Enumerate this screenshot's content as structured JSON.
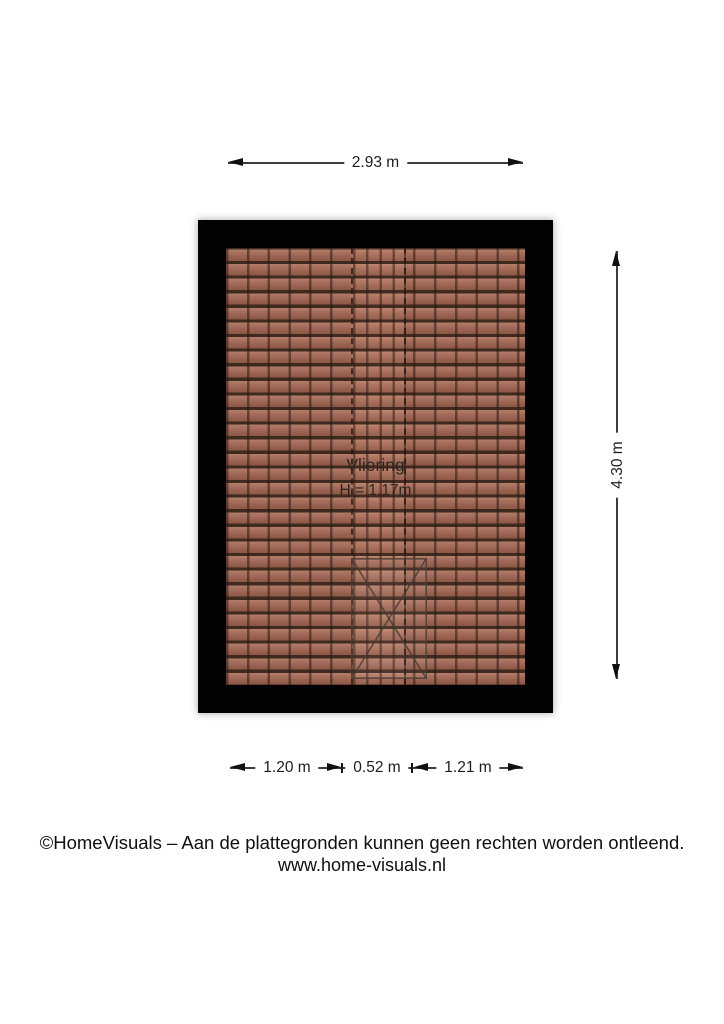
{
  "floorplan": {
    "room": {
      "name": "Vliering",
      "height": "H = 1.17m"
    },
    "dimensions": {
      "width_top": "2.93 m",
      "height_right": "4.30 m",
      "bottom_segments": [
        "1.20 m",
        "0.52 m",
        "1.21 m"
      ]
    },
    "colors": {
      "wall": "#020202",
      "tile_base": "#9c6452",
      "tile_grout": "#3f2a20",
      "ridge_strip": "#a7705c",
      "dimension_line": "#3d3d3d",
      "arrowhead": "#101010",
      "background": "#ffffff"
    }
  },
  "footer": {
    "copyright": "©HomeVisuals – Aan de plattegronden kunnen geen rechten worden ontleend.",
    "website": "www.home-visuals.nl"
  }
}
